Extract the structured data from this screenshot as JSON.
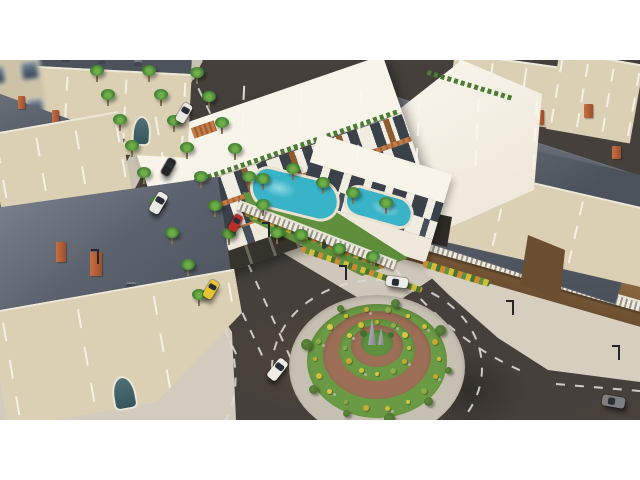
{
  "scene": {
    "description": "Aerial 3D architectural rendering: modern white residential complex with rooftop terraces and swimming pool, palm-lined avenue, landscaped traffic roundabout with obelisk sculpture, surrounded by classic European stone buildings with slate mansard roofs and brick chimneys",
    "palette": {
      "letterbox": "#ffffff",
      "asphalt": "#45403c",
      "sidewalk": "#cfc8ba",
      "sidewalk2": "#d6cfc0",
      "plaza": "#d3ccbe",
      "facade": "#dbd0b4",
      "roofslate": "#6b727c",
      "roofdark": "#4c525c",
      "chimney_brick": "#b5603a",
      "window_glass": "#51626f",
      "modern_white": "#f2ede2",
      "modern_roof": "#f8f4ea",
      "wood_louver": "#8f5c30",
      "canopy_orange": "#c27c46",
      "dark_base": "#36322c",
      "lawn": "#5f8f3f",
      "pool_water": "#39b3c7",
      "pool_light": "#8fd9e4",
      "ring_gray": "#c6c0b2",
      "ring_brick": "#9b6e55",
      "ring_green": "#6a9a43",
      "marking_white": "#dcdbd6",
      "dirt": "#7c5c3a",
      "obelisk_gray": "#979da2"
    },
    "vehicles": [
      {
        "name": "parked-white-van",
        "color": "#e9e7e2",
        "x": 184,
        "y": 53,
        "w": 10,
        "h": 20,
        "rot": 30,
        "axis": "v"
      },
      {
        "name": "parked-dark-car",
        "color": "#26262a",
        "x": 168,
        "y": 107,
        "w": 9,
        "h": 18,
        "rot": 30,
        "axis": "v"
      },
      {
        "name": "driving-white-van",
        "color": "#eceae6",
        "x": 158,
        "y": 143,
        "w": 11,
        "h": 22,
        "rot": 30,
        "axis": "v"
      },
      {
        "name": "red-hatchback",
        "color": "#b82e28",
        "x": 235,
        "y": 163,
        "w": 9,
        "h": 18,
        "rot": 30,
        "axis": "v"
      },
      {
        "name": "yellow-taxi",
        "color": "#e6c430",
        "x": 211,
        "y": 229,
        "w": 10,
        "h": 19,
        "rot": 30,
        "axis": "v"
      },
      {
        "name": "white-convertible",
        "color": "#eeede9",
        "x": 277,
        "y": 309,
        "w": 11,
        "h": 23,
        "rot": 38,
        "axis": "v"
      },
      {
        "name": "white-sedan-roundabout",
        "color": "#ececea",
        "x": 397,
        "y": 222,
        "w": 22,
        "h": 10,
        "rot": 8,
        "axis": "h"
      },
      {
        "name": "gray-suv",
        "color": "#7e7e80",
        "x": 613,
        "y": 341,
        "w": 23,
        "h": 11,
        "rot": 10,
        "axis": "h"
      }
    ],
    "palms": [
      [
        96,
        14
      ],
      [
        107,
        38
      ],
      [
        119,
        63
      ],
      [
        131,
        89
      ],
      [
        143,
        116
      ],
      [
        156,
        145
      ],
      [
        171,
        176
      ],
      [
        187,
        208
      ],
      [
        198,
        238
      ],
      [
        148,
        14
      ],
      [
        160,
        38
      ],
      [
        173,
        64
      ],
      [
        186,
        91
      ],
      [
        200,
        120
      ],
      [
        214,
        149
      ],
      [
        228,
        177
      ],
      [
        196,
        16
      ],
      [
        208,
        40
      ],
      [
        221,
        66
      ],
      [
        234,
        92
      ],
      [
        248,
        120
      ],
      [
        262,
        148
      ],
      [
        276,
        176
      ],
      [
        262,
        122
      ],
      [
        292,
        112
      ],
      [
        322,
        126
      ],
      [
        352,
        136
      ],
      [
        385,
        146
      ],
      [
        300,
        178
      ],
      [
        338,
        192
      ],
      [
        372,
        200
      ]
    ],
    "lamps": [
      [
        97,
        189
      ],
      [
        268,
        162
      ],
      [
        512,
        240
      ],
      [
        618,
        285
      ],
      [
        345,
        205
      ]
    ],
    "pedestrian": {
      "x": 322,
      "y": 181
    },
    "roundabout": {
      "cx": 377,
      "rings": [
        {
          "rx": 88,
          "ry": 72,
          "cy": 307,
          "color": "#c6c0b2"
        },
        {
          "rx": 70,
          "ry": 57,
          "cy": 301,
          "color": "#6a9a43"
        },
        {
          "rx": 54,
          "ry": 44,
          "cy": 295,
          "color": "#9b6e55"
        },
        {
          "rx": 38,
          "ry": 31,
          "cy": 290,
          "color": "#6a9a43"
        },
        {
          "rx": 26,
          "ry": 21,
          "cy": 286,
          "color": "#9b6e55"
        },
        {
          "rx": 16,
          "ry": 13,
          "cy": 283,
          "color": "#5f8f3f"
        }
      ],
      "bushRings": [
        {
          "rx": 62,
          "ry": 50,
          "cy": 299,
          "n": 18
        },
        {
          "rx": 32,
          "ry": 26,
          "cy": 288,
          "n": 12
        }
      ],
      "bushColors": [
        "#d2bc3c",
        "#c8a830",
        "#8faa4a",
        "#d8c648"
      ],
      "rockColor": "#b0aca0",
      "treeAngles": [
        10,
        45,
        80,
        115,
        150,
        195,
        240,
        285,
        330
      ],
      "treeRing": {
        "rx": 73,
        "ry": 59,
        "cy": 300
      },
      "treeColor": "#4a6e30",
      "obelisks": [
        {
          "x": 368,
          "y": 258,
          "w": 8,
          "h": 27
        },
        {
          "x": 378,
          "y": 268,
          "w": 6,
          "h": 17
        }
      ]
    },
    "facade_windows": {
      "rows_note": "rows,cols per facade are encoded in data-windows attributes"
    },
    "buildings": [
      "background-haussmann-block",
      "left-haussmann-block",
      "bottom-left-haussmann-corner",
      "top-right-haussmann-block",
      "right-haussmann-building",
      "modern-complex-main-wing",
      "modern-complex-side-wing",
      "modern-white-annex-hall"
    ],
    "landscape": [
      "palm-trees",
      "roundabout-gardens",
      "pool-garden-lawn",
      "yellow-flower-hedges",
      "rooftop-planters"
    ]
  }
}
